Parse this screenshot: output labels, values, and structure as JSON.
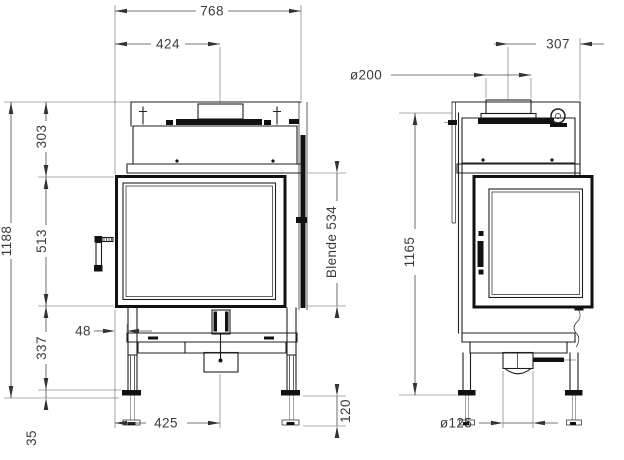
{
  "drawing": {
    "title": "fireplace-insert-dimension-drawing",
    "front_view": {
      "overall_width": "768",
      "flue_offset_left": "424",
      "overall_height": "1188",
      "top_section": "303",
      "door_height": "513",
      "trim_label": "Blende 534",
      "base_section": "337",
      "foot_min": "35",
      "frame_offset": "48",
      "base_width": "425",
      "foot_adjust": "120"
    },
    "side_view": {
      "flue_offset_right": "307",
      "flue_diameter": "ø200",
      "overall_height": "1165",
      "duct_diameter": "ø125"
    }
  }
}
